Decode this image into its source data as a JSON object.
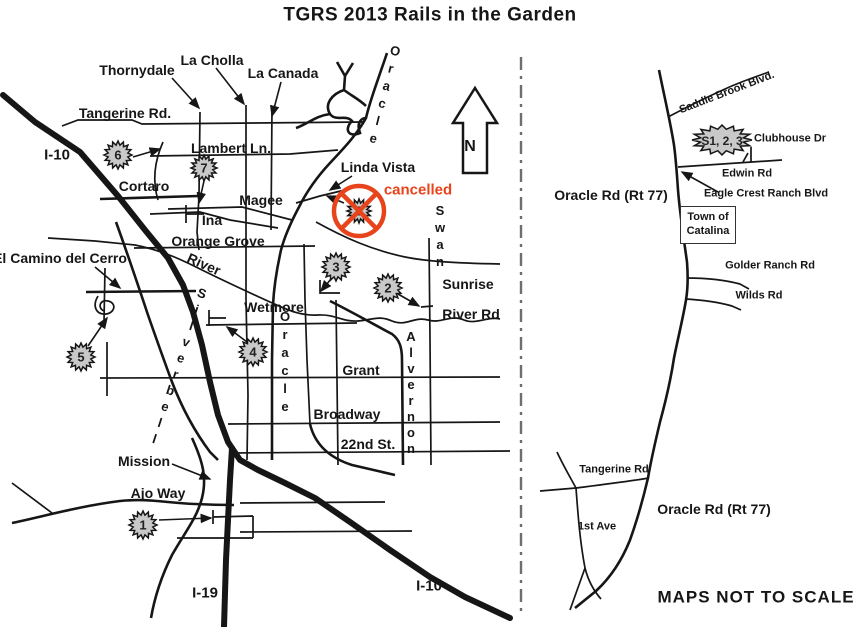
{
  "title": "TGRS 2013 Rails in the Garden",
  "colors": {
    "cancel_red": "#e8441c",
    "road_black": "#161616",
    "starburst_gray": "#c9c9c9"
  },
  "north_arrow": {
    "label": "N"
  },
  "left_map": {
    "roads": {
      "thornydale": "Thornydale",
      "la_cholla": "La Cholla",
      "la_canada": "La Canada",
      "tangerine": "Tangerine Rd.",
      "i10_nw": "I-10",
      "lambert": "Lambert Ln.",
      "cortaro": "Cortaro",
      "magee": "Magee",
      "ina": "Ina",
      "linda_vista": "Linda Vista",
      "oracle_top": "Oracle",
      "orange_grove": "Orange Grove",
      "river": "River",
      "el_camino_del_cerro": "El Camino del Cerro",
      "wetmore": "Wetmore",
      "sunrise": "Sunrise",
      "river_rd": "River Rd",
      "swan": "Swan",
      "grant": "Grant",
      "oracle_mid": "Oracle",
      "alvernon": "Alvernon",
      "silverbell": "Silverbell",
      "broadway": "Broadway",
      "twenty_second": "22nd St.",
      "mission": "Mission",
      "ajo_way": "Ajo Way",
      "i19": "I-19",
      "i10_se": "I-10"
    },
    "stops": {
      "s1": "1",
      "s2": "2",
      "s3": "3",
      "s4": "4",
      "s5": "5",
      "s6": "6",
      "s7": "7",
      "s8": "8"
    },
    "cancelled_note": "cancelled"
  },
  "right_map": {
    "roads": {
      "saddle_brook": "Saddle Brook Blvd.",
      "clubhouse": "Clubhouse Dr",
      "edwin": "Edwin Rd",
      "oracle_upper": "Oracle Rd (Rt 77)",
      "eagle_crest": "Eagle Crest Ranch Blvd",
      "golder_ranch": "Golder Ranch Rd",
      "wilds": "Wilds Rd",
      "tangerine": "Tangerine Rd",
      "first_ave": "1st Ave",
      "oracle_lower": "Oracle Rd (Rt 77)"
    },
    "stops_label": "S1, 2, 3",
    "town_box": {
      "line1": "Town of",
      "line2": "Catalina"
    },
    "scale_note": "MAPS  NOT TO SCALE"
  }
}
